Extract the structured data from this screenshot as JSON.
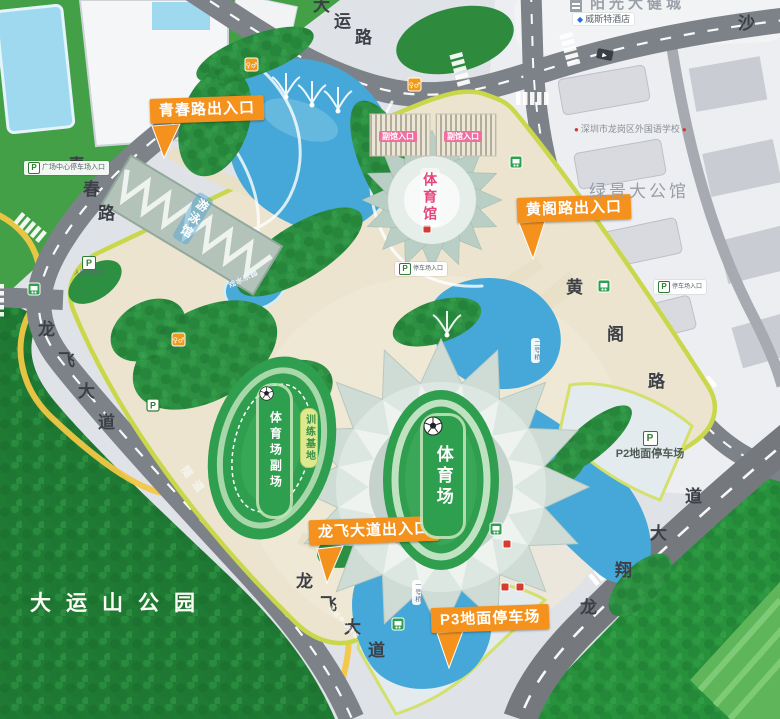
{
  "park": {
    "name": "大运山公园",
    "tunnel": "隧道",
    "greenway_stop": "大运中心绿道"
  },
  "roads": {
    "dayun": "大运路",
    "qingchun": "青春路",
    "longfei": "龙飞大道",
    "huangge": "黄阁路",
    "longxiang": "龙翔大道",
    "sha": "沙"
  },
  "entrances": {
    "qingchun": "青春路出入口",
    "huangge": "黄阁路出入口",
    "longfei": "龙飞大道出入口"
  },
  "venues": {
    "stadium": "体育场",
    "gymnasium": "体育馆",
    "natatorium": "游泳馆",
    "aux_field": "体育场副场",
    "training_base": "训练基地",
    "water_park": "戏水乐园",
    "hall_entrance": "副馆入口"
  },
  "parking": {
    "icon_letter": "P",
    "p2": "P2地面停车场",
    "p3": "P3地面停车场",
    "civil_defense": "人防停车场",
    "plaza_center": "广场中心停车场入口",
    "lot_entrance": "停车场入口"
  },
  "landmarks": {
    "sunshine_city": "阳光大健城",
    "hotel": "威斯特酒店",
    "school": "深圳市龙岗区外国语学校",
    "mansion": "绿景大公馆"
  },
  "bridges": {
    "no1": "一号桥",
    "no2": "二号桥"
  },
  "icons": {
    "wc": "♀♂",
    "diamond": "◆",
    "dot": "●",
    "arrow": "▶"
  },
  "colors": {
    "entrance_orange": "#f5921e",
    "venue_green": "#2e9e4f",
    "water_blue": "#45a8d8",
    "road_gray": "#7d8288",
    "forest_green": "#1f7a33"
  }
}
